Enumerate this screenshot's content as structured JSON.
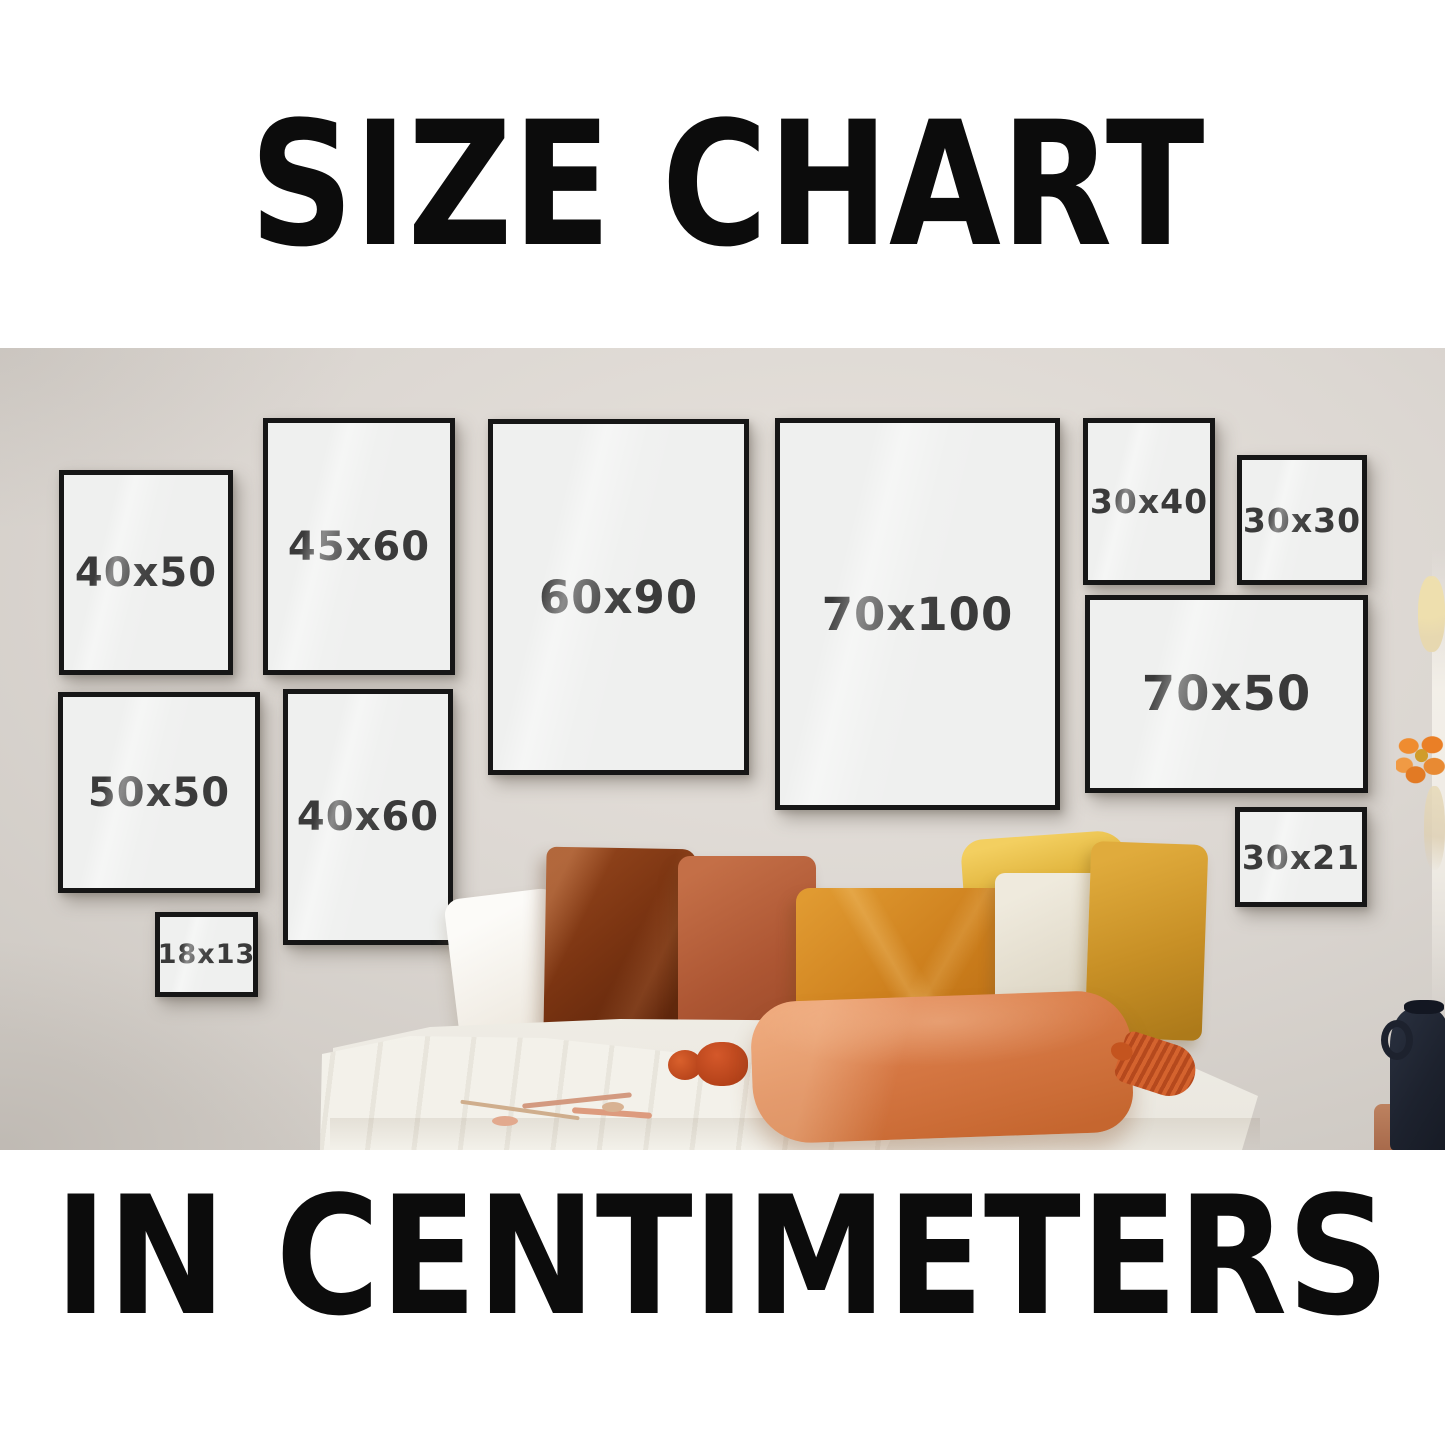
{
  "header": {
    "title": "SIZE CHART"
  },
  "footer": {
    "title": "IN CENTIMETERS"
  },
  "unit": "cm",
  "frames": [
    {
      "label": "40x50",
      "width_cm": 40,
      "height_cm": 50,
      "orientation": "portrait"
    },
    {
      "label": "45x60",
      "width_cm": 45,
      "height_cm": 60,
      "orientation": "portrait"
    },
    {
      "label": "60x90",
      "width_cm": 60,
      "height_cm": 90,
      "orientation": "portrait"
    },
    {
      "label": "70x100",
      "width_cm": 70,
      "height_cm": 100,
      "orientation": "portrait"
    },
    {
      "label": "30x40",
      "width_cm": 30,
      "height_cm": 40,
      "orientation": "portrait"
    },
    {
      "label": "30x30",
      "width_cm": 30,
      "height_cm": 30,
      "orientation": "square"
    },
    {
      "label": "50x50",
      "width_cm": 50,
      "height_cm": 50,
      "orientation": "square"
    },
    {
      "label": "40x60",
      "width_cm": 40,
      "height_cm": 60,
      "orientation": "portrait"
    },
    {
      "label": "70x50",
      "width_cm": 70,
      "height_cm": 50,
      "orientation": "landscape"
    },
    {
      "label": "18x13",
      "width_cm": 18,
      "height_cm": 13,
      "orientation": "landscape"
    },
    {
      "label": "30x21",
      "width_cm": 30,
      "height_cm": 21,
      "orientation": "landscape"
    }
  ],
  "colors": {
    "headline_text": "#0c0c0c",
    "wall": "#dcd7d2",
    "frame_border": "#161616",
    "frame_fill": "#eff0ef",
    "label_text": "#3a3a3a",
    "pillow_rust": "#7c3512",
    "pillow_terracotta": "#ad5633",
    "pillow_amber": "#cd7f1d",
    "pillow_cream": "#e8e2d3",
    "pillow_mustard": "#c89026",
    "pillow_front_orange": "#d67844",
    "tassel": "#b6431a",
    "bedding": "#f6f4ee",
    "vase": "#1d222e",
    "flower": "#ea7f26"
  }
}
